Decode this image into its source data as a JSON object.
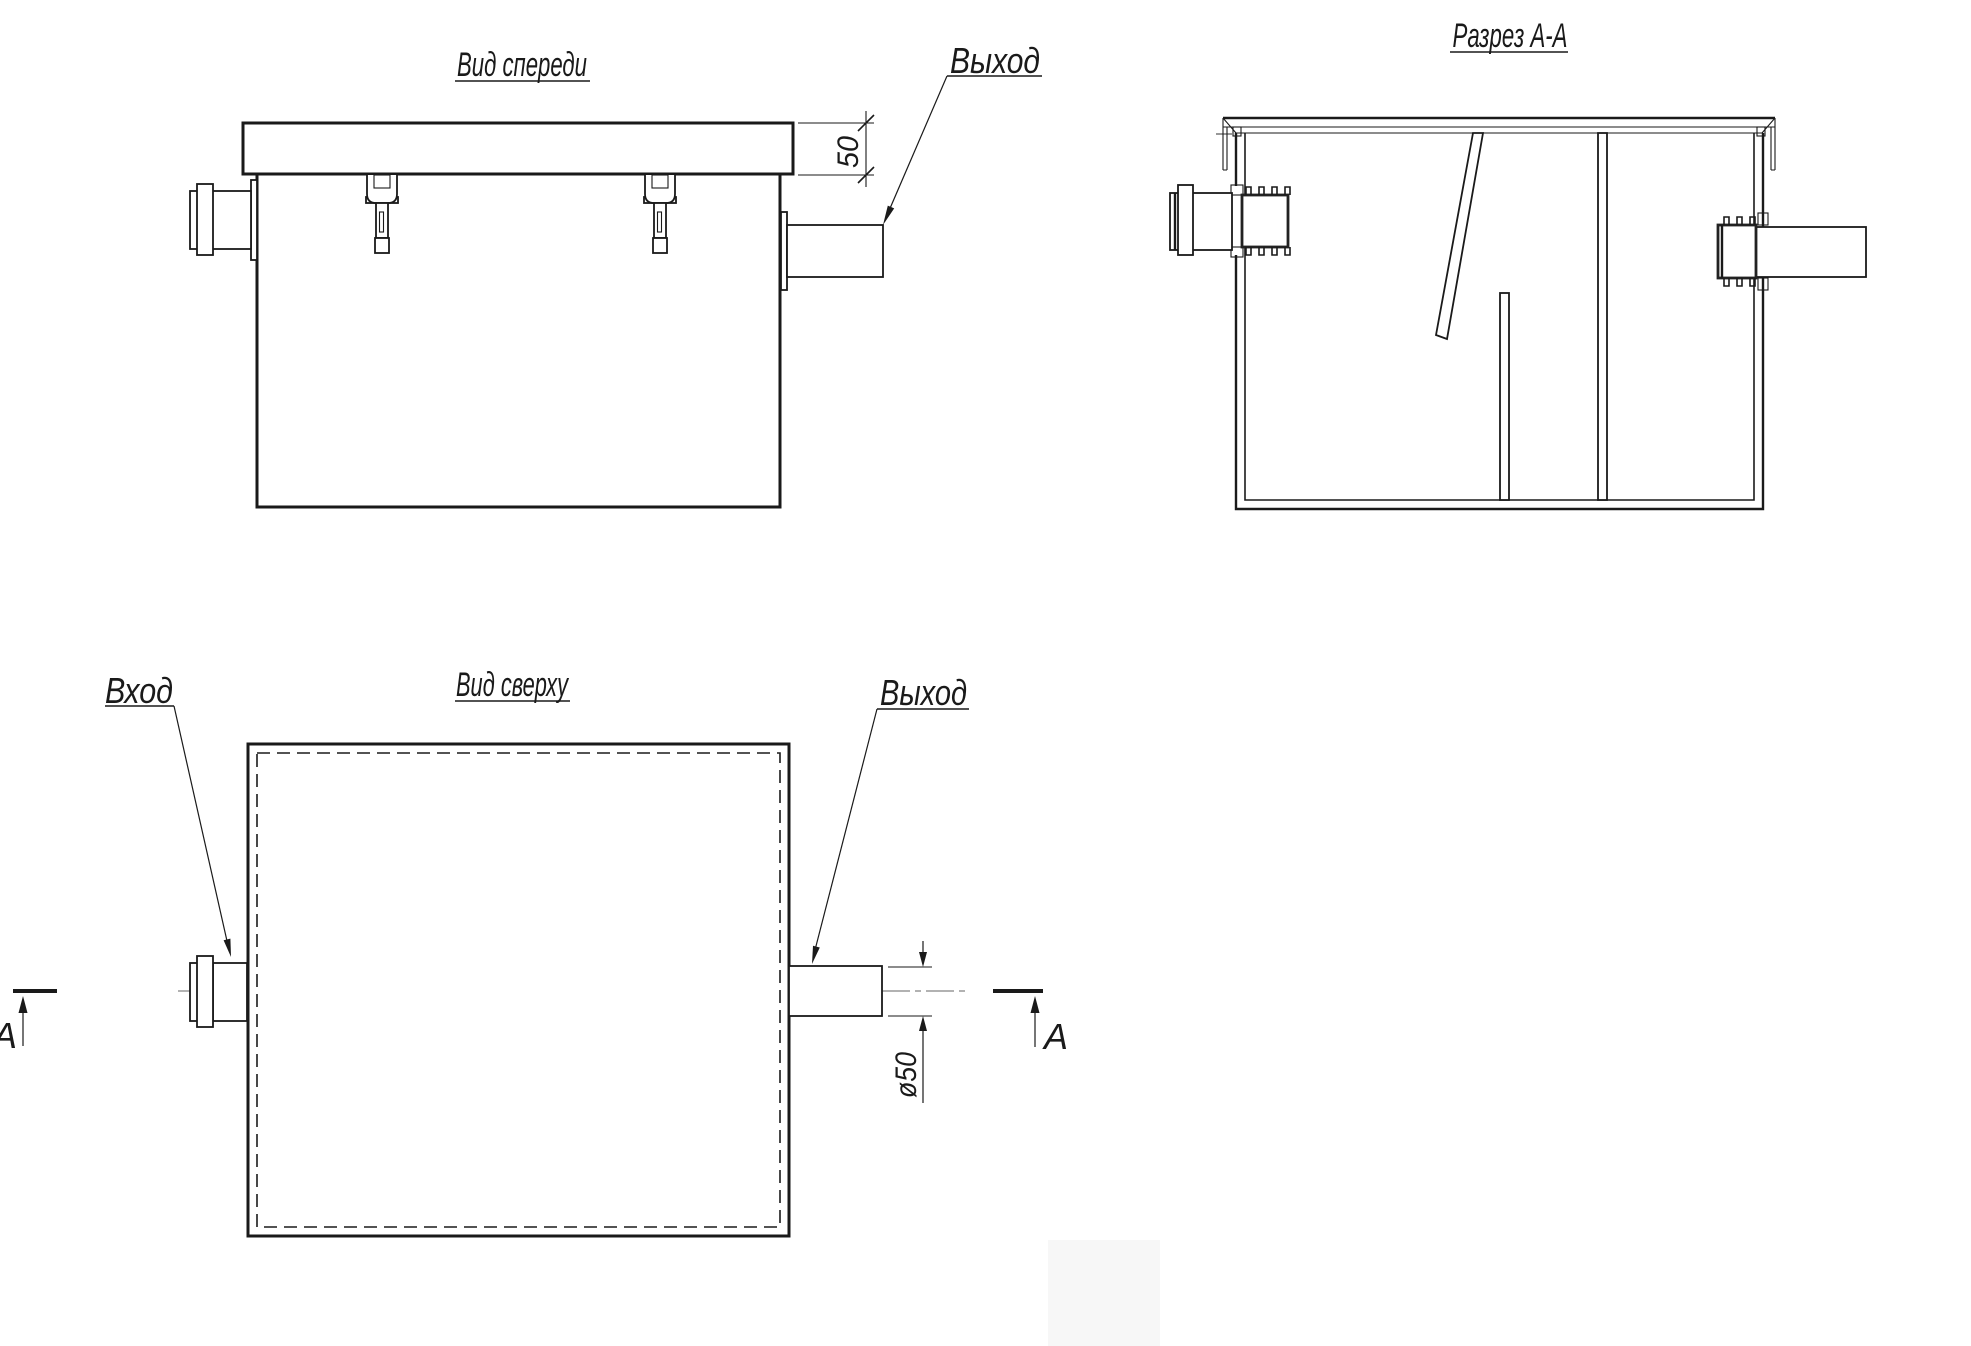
{
  "canvas": {
    "background": "#ffffff",
    "ink": "#1a1a1a"
  },
  "front_view": {
    "title": "Вид спереди",
    "outlet_label": "Выход",
    "lid_height_dim": "50"
  },
  "section_view": {
    "title": "Разрез А-А"
  },
  "top_view": {
    "title": "Вид сверху",
    "inlet_label": "Вход",
    "outlet_label": "Выход",
    "outlet_diameter_dim": "ø50",
    "section_letter_left": "А",
    "section_letter_right": "А"
  }
}
